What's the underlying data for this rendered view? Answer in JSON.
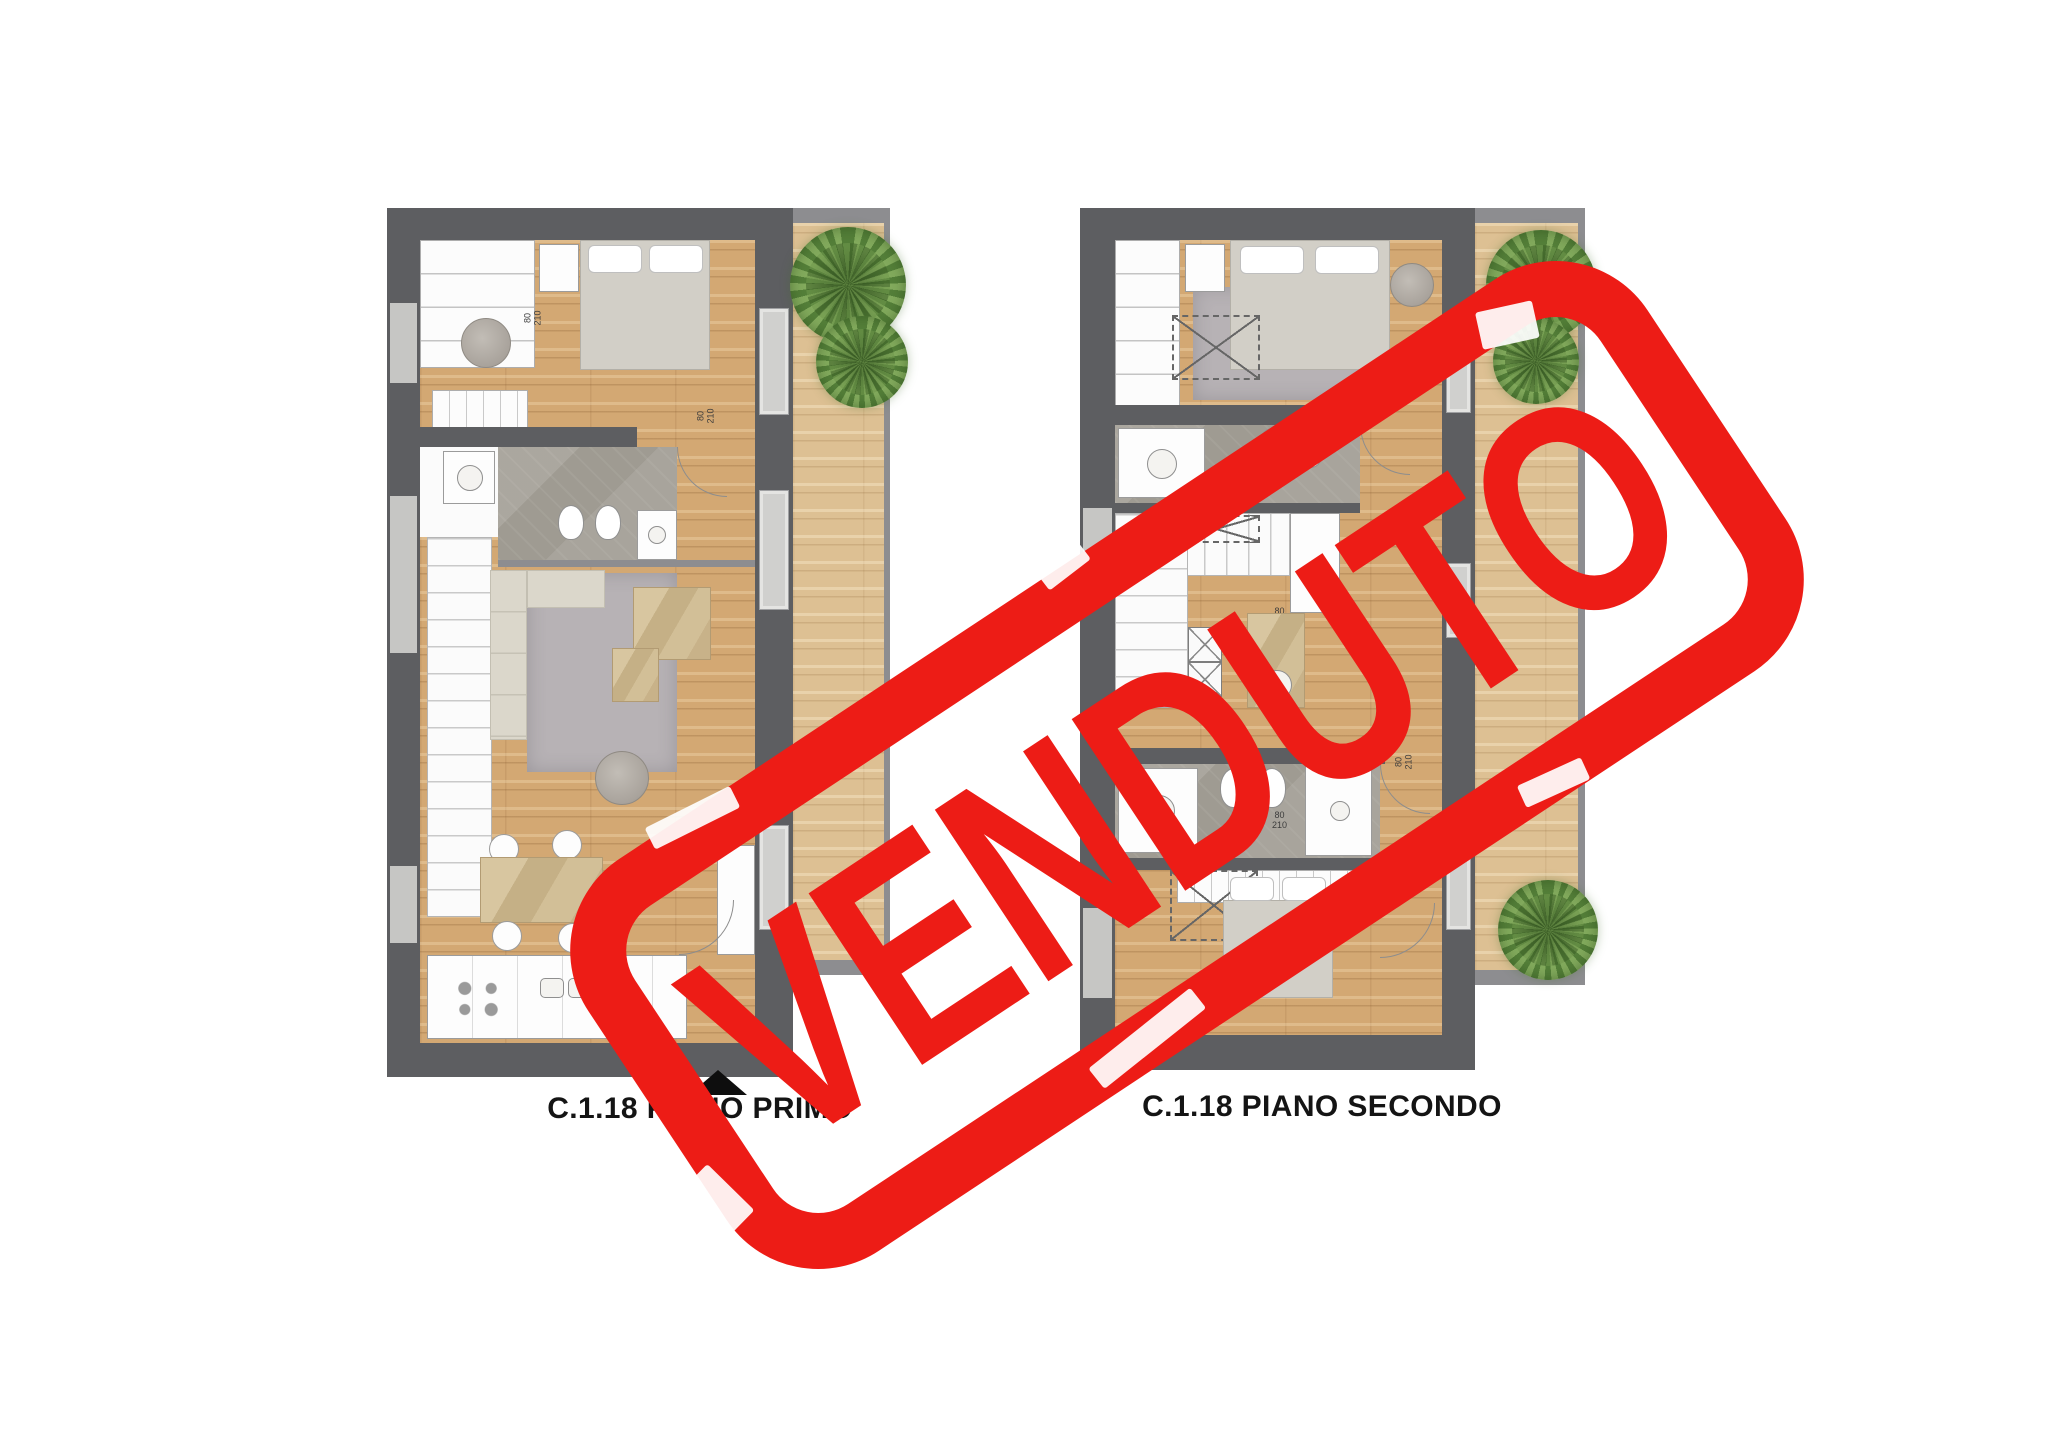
{
  "stamp": {
    "text": "VENDUTO",
    "color": "#ED1C16"
  },
  "plans": [
    {
      "caption": "C.1.18 PIANO PRIMO"
    },
    {
      "caption": "C.1.18 PIANO SECONDO"
    }
  ],
  "dims": [
    {
      "w": "80",
      "h": "210"
    },
    {
      "w": "80",
      "h": "210"
    },
    {
      "w": "80",
      "h": "210"
    },
    {
      "w": "80",
      "h": "210"
    },
    {
      "w": "80",
      "h": "210"
    }
  ],
  "colors": {
    "stamp_red": "#ED1C16",
    "wall_dark": "#5d5e61",
    "wood_floor": "#d3a873",
    "balcony_wood": "#ddc093",
    "bath_tile": "#9f9b92",
    "caption_text": "#141414"
  }
}
